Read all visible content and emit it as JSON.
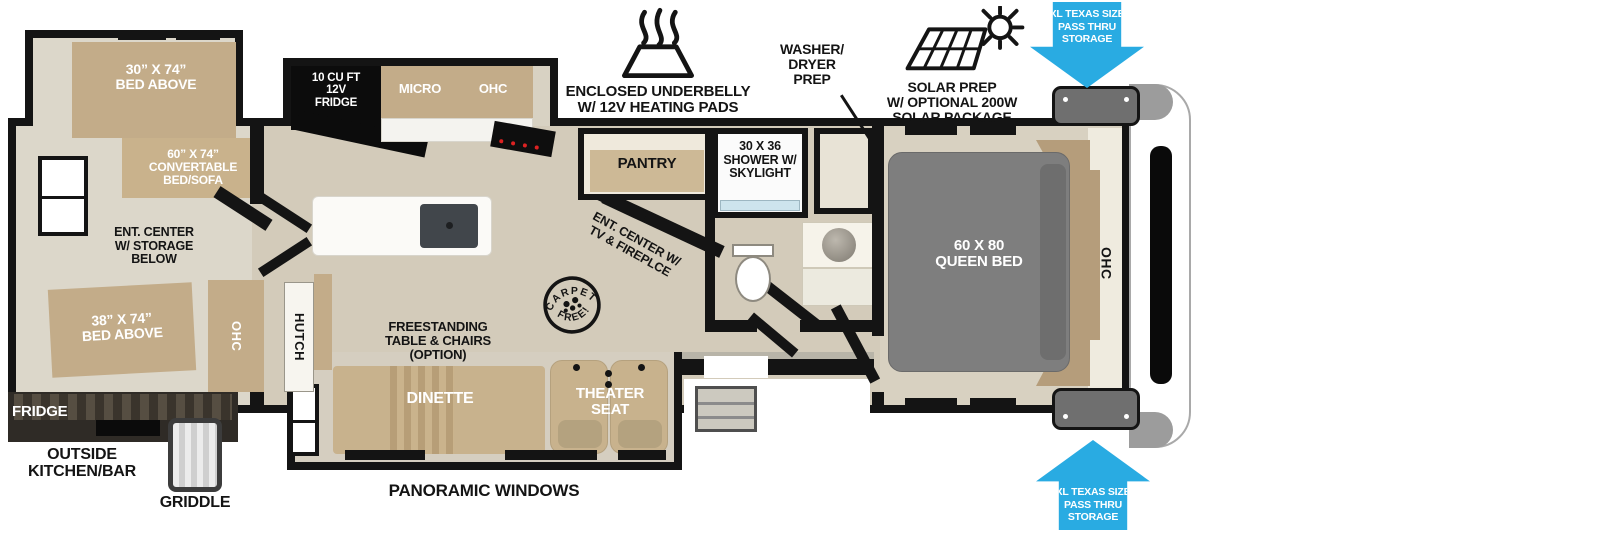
{
  "colors": {
    "arrow_blue": "#29abe2",
    "furniture_tan": "#c3ac89",
    "bed_gray": "#7e7e7e",
    "wall_black": "#141414",
    "floor_beige": "#d3cbba"
  },
  "callouts": {
    "underbelly": "ENCLOSED UNDERBELLY\nW/ 12V HEATING PADS",
    "washer_dryer": "WASHER/\nDRYER\nPREP",
    "solar": "SOLAR PREP\nW/ OPTIONAL 200W\nSOLAR PACKAGE",
    "pass_thru_top": "XL TEXAS SIZE\nPASS THRU\nSTORAGE",
    "pass_thru_bottom": "XL TEXAS SIZE\nPASS THRU\nSTORAGE",
    "panoramic_windows": "PANORAMIC WINDOWS",
    "carpet_free_top": "CARPET",
    "carpet_free_bottom": "FREE!"
  },
  "outside_kitchen": {
    "fridge": "FRIDGE",
    "label": "OUTSIDE\nKITCHEN/BAR",
    "griddle": "GRIDDLE"
  },
  "bunk_room": {
    "bed_above_top": "30” X 74”\nBED ABOVE",
    "convertible_bed": "60” X 74”\nCONVERTABLE\nBED/SOFA",
    "ent_center": "ENT. CENTER\nW/ STORAGE\nBELOW",
    "bed_above_bottom": "38” X 74”\nBED ABOVE"
  },
  "kitchen": {
    "fridge": "10 CU FT\n12V\nFRIDGE",
    "micro": "MICRO",
    "ohc": "OHC",
    "pantry": "PANTRY"
  },
  "living": {
    "ohc": "OHC",
    "hutch": "HUTCH",
    "freestanding_table": "FREESTANDING\nTABLE & CHAIRS\n(OPTION)",
    "ent_center": "ENT. CENTER W/\nTV & FIREPLCE",
    "dinette": "DINETTE",
    "theater_seat": "THEATER\nSEAT"
  },
  "bathroom": {
    "shower": "30 X 36\nSHOWER W/\nSKYLIGHT"
  },
  "bedroom": {
    "queen_bed": "60 X 80\nQUEEN BED",
    "ohc": "OHC"
  }
}
